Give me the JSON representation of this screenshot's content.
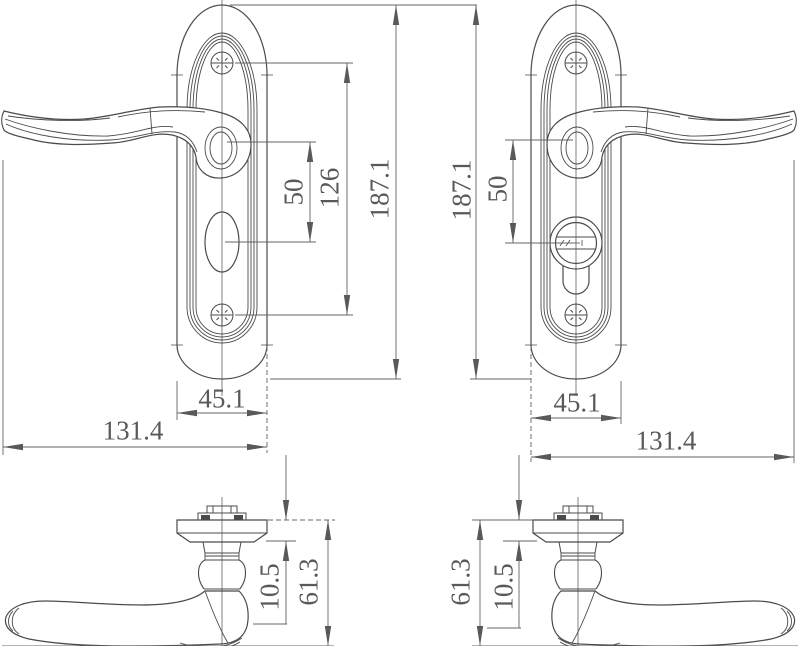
{
  "drawing": {
    "type": "technical-drawing-door-handle",
    "background_color": "#ffffff",
    "object_line_color": "#4a4b4d",
    "dimension_line_color": "#636466",
    "dimension_text_color": "#58595a"
  },
  "views": {
    "front_left": {
      "description": "front view, left-hand lever on plate with oval thumbturn",
      "dims": {
        "handle_to_turn": "50",
        "screw_spacing": "126",
        "plate_height": "187.1",
        "plate_width": "45.1",
        "overall_length": "131.4"
      }
    },
    "front_right": {
      "description": "front view, right-hand lever on plate with euro cylinder keyhole",
      "dims": {
        "plate_height": "187.1",
        "handle_to_cylinder": "50",
        "plate_width": "45.1",
        "overall_length": "131.4"
      }
    },
    "side_left": {
      "description": "side view, lever pointing left",
      "dims": {
        "plate_thickness": "10.5",
        "projection": "61.3"
      }
    },
    "side_right": {
      "description": "side view, lever pointing right",
      "dims": {
        "projection": "61.3",
        "plate_thickness": "10.5"
      }
    }
  }
}
